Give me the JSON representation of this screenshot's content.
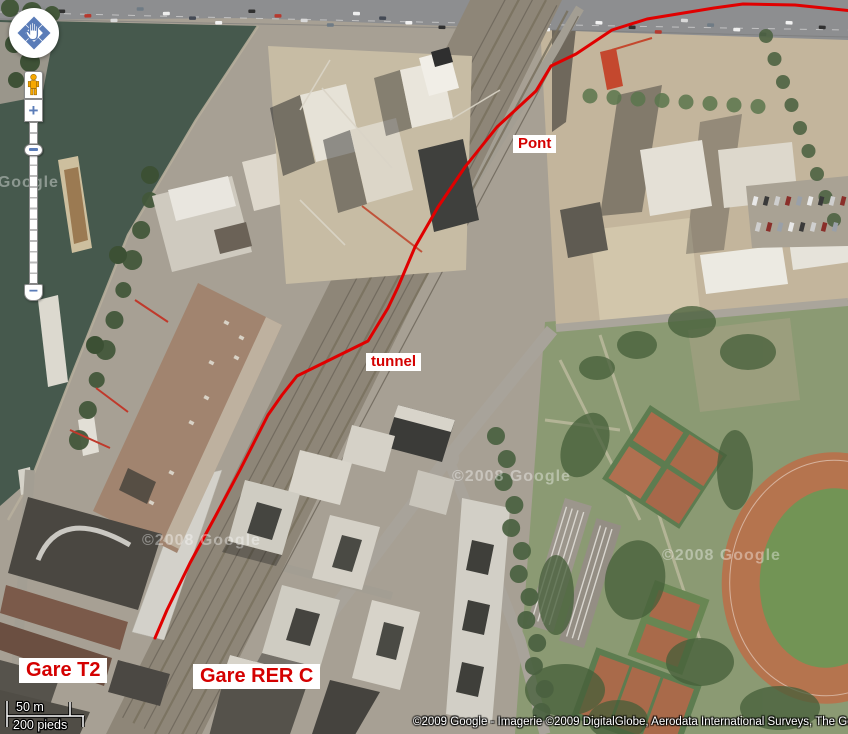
{
  "colors": {
    "route_red": "#e00000",
    "label_red": "#d40000",
    "control_blue": "#5a7cb8",
    "pegman_orange": "#f7a800",
    "water_green": "#46594d"
  },
  "map": {
    "view_type": "satellite",
    "watermark": "©2008 Google",
    "copyright": "©2009 Google - Imagerie ©2009 DigitalGlobe, Aerodata International Surveys, The GeoInfo",
    "scale_bar": {
      "metric": "50 m",
      "imperial": "200 pieds"
    },
    "labels": {
      "pont": "Pont",
      "tunnel": "tunnel",
      "gare_t2": "Gare T2",
      "gare_rer_c": "Gare RER C"
    },
    "route": {
      "color": "#e00000",
      "stroke_width": 3,
      "points": [
        [
          862,
          12
        ],
        [
          795,
          5
        ],
        [
          743,
          4
        ],
        [
          714,
          8
        ],
        [
          647,
          19
        ],
        [
          612,
          30
        ],
        [
          576,
          54
        ],
        [
          551,
          66
        ],
        [
          536,
          91
        ],
        [
          497,
          127
        ],
        [
          465,
          167
        ],
        [
          438,
          207
        ],
        [
          415,
          247
        ],
        [
          398,
          287
        ],
        [
          388,
          308
        ],
        [
          368,
          341
        ],
        [
          297,
          376
        ],
        [
          282,
          395
        ],
        [
          268,
          415
        ],
        [
          240,
          470
        ],
        [
          215,
          517
        ],
        [
          190,
          563
        ],
        [
          167,
          610
        ],
        [
          155,
          638
        ]
      ]
    }
  },
  "controls": {
    "zoom_in_glyph": "+",
    "zoom_out_glyph": "−"
  }
}
